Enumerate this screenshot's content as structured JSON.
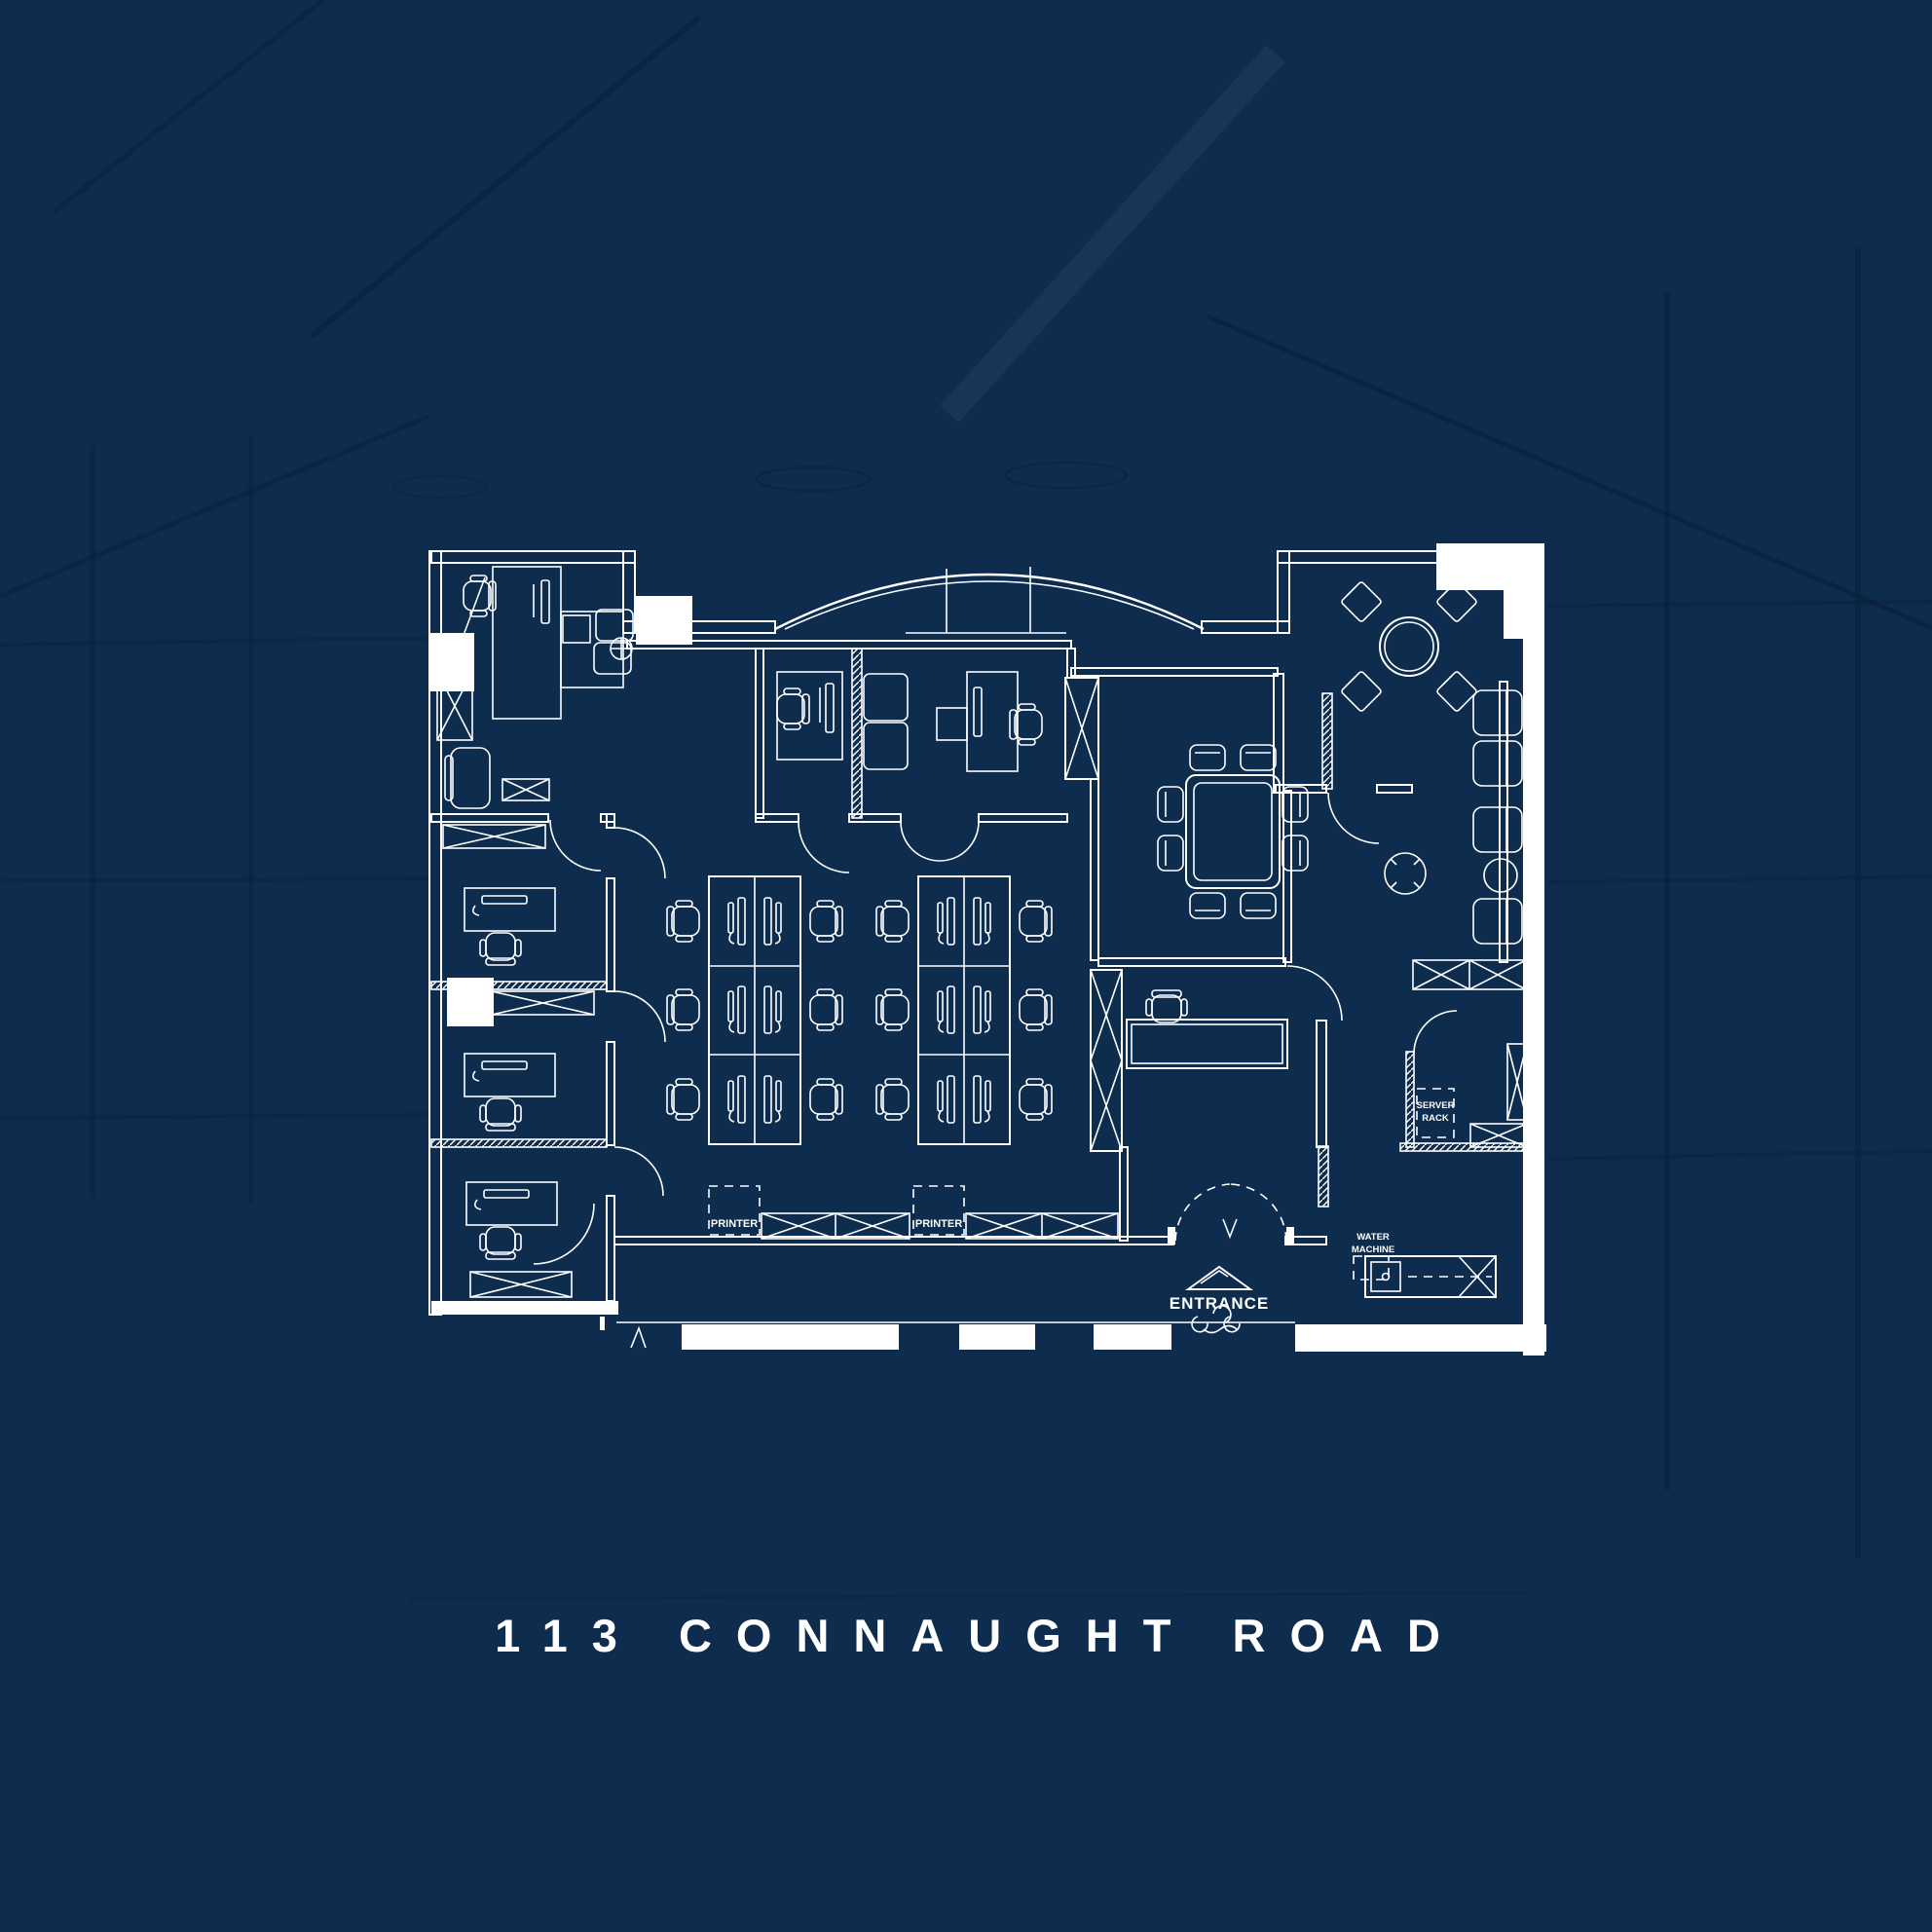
{
  "title": {
    "text": "113 CONNAUGHT ROAD"
  },
  "plan": {
    "labels": {
      "printer_left": "PRINTER",
      "printer_right": "PRINTER",
      "entrance": "ENTRANCE",
      "server_rack_line1": "SERVER",
      "server_rack_line2": "RACK",
      "water_machine_line1": "WATER",
      "water_machine_line2": "MACHINE"
    },
    "line_color": "#ffffff"
  },
  "background": {
    "ceiling_navy": "#12355b",
    "mid_blue": "#1b578a",
    "floor_teal": "#2279ae"
  }
}
